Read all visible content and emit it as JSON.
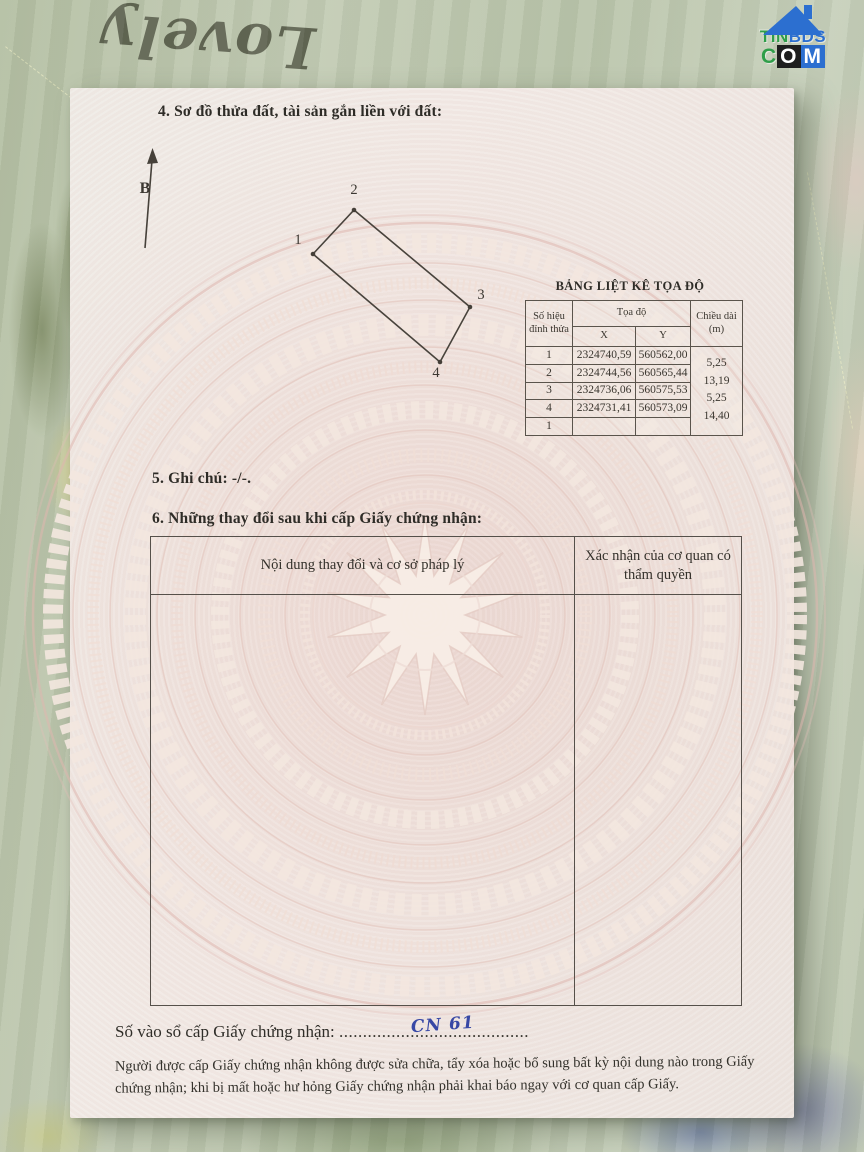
{
  "fabric": {
    "handwriting": "Lovely"
  },
  "logo": {
    "tin": "TIN",
    "bds": "BDS",
    "c": "C",
    "o": "O",
    "m": "M"
  },
  "document": {
    "section4_title": "4. Sơ đồ thửa đất, tài sản gắn liền với đất:",
    "north_label": "B",
    "diagram": {
      "vertex_labels": [
        "1",
        "2",
        "3",
        "4"
      ]
    },
    "coord_table": {
      "title": "BẢNG LIỆT KÊ TỌA ĐỘ",
      "header_vertex": "Số hiệu đỉnh thửa",
      "header_coords": "Tọa độ",
      "header_x": "X",
      "header_y": "Y",
      "header_length": "Chiều dài (m)",
      "rows": [
        {
          "id": "1",
          "x": "2324740,59",
          "y": "560562,00"
        },
        {
          "id": "2",
          "x": "2324744,56",
          "y": "560565,44"
        },
        {
          "id": "3",
          "x": "2324736,06",
          "y": "560575,53"
        },
        {
          "id": "4",
          "x": "2324731,41",
          "y": "560573,09"
        },
        {
          "id": "1",
          "x": "",
          "y": ""
        }
      ],
      "lengths": [
        "5,25",
        "13,19",
        "5,25",
        "14,40"
      ]
    },
    "section5_text": "5. Ghi chú: -/-.",
    "section6_title": "6. Những thay đổi sau khi cấp Giấy chứng nhận:",
    "changes_table": {
      "col_content": "Nội dung thay đổi và cơ sở pháp lý",
      "col_confirm": "Xác nhận của cơ quan có thẩm quyền"
    },
    "serial_label": "Số vào sổ cấp Giấy chứng nhận:",
    "serial_value": "CN 61",
    "serial_dots": "........................................",
    "footer_note": "Người được cấp Giấy chứng nhận không được sửa chữa, tẩy xóa hoặc bổ sung bất kỳ nội dung nào trong Giấy chứng nhận; khi bị mất hoặc hư hỏng Giấy chứng nhận phải khai báo ngay với cơ quan cấp Giấy."
  },
  "colors": {
    "accent_blue": "#2c6fd0",
    "accent_green": "#2f9e49",
    "handwriting_blue": "#3848a5"
  }
}
